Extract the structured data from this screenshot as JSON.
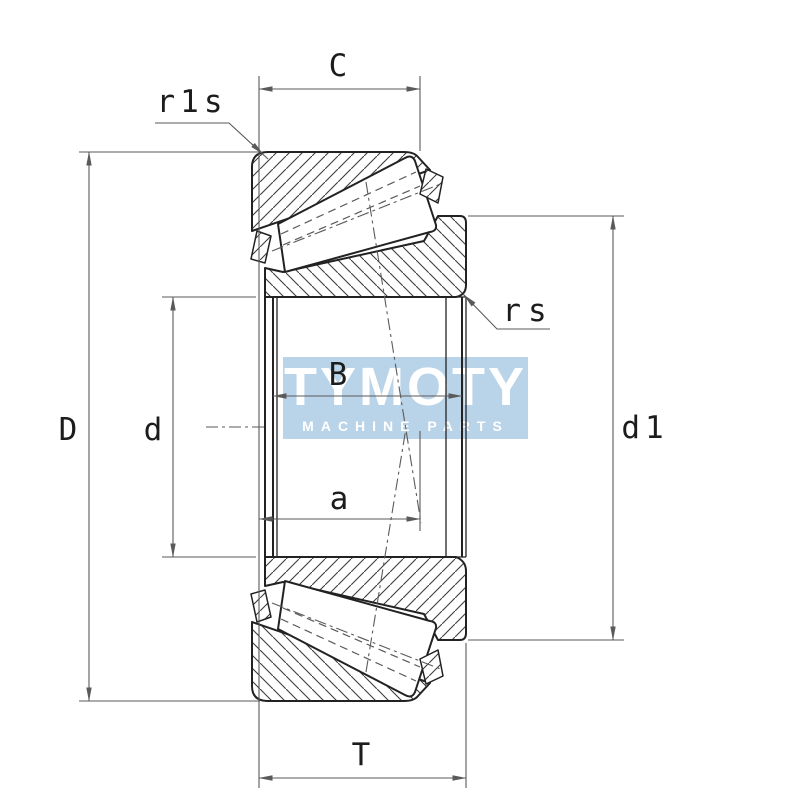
{
  "drawing": {
    "kind": "tapered-roller-bearing-cross-section",
    "view": "axial cross-section technical drawing"
  },
  "labels": {
    "outer_ring_width": "C",
    "outer_ring_chamfer": "r1s",
    "inner_ring_chamfer": "rs",
    "outside_diameter": "D",
    "bore_diameter": "d",
    "inner_ring_width": "B",
    "load_center_distance": "a",
    "rib_diameter": "d1",
    "total_width": "T"
  },
  "watermark": {
    "line1": "TYMOTY",
    "line2": "MACHINE PARTS"
  },
  "colors": {
    "line": "#222222",
    "dim_line": "#5a5a5a",
    "hatch": "#3c3c3c",
    "watermark_band": "#b9d3e8",
    "watermark_text": "#ffffff",
    "label": "#1c1c1c",
    "background": "#ffffff"
  }
}
